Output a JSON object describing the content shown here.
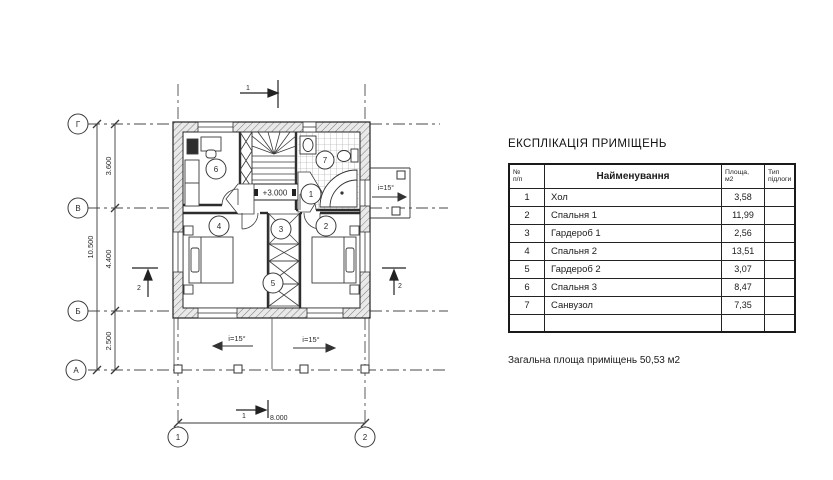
{
  "sheet": {
    "title": "ЕКСПЛІКАЦІЯ ПРИМІЩЕНЬ",
    "table": {
      "headers": {
        "num_l1": "№",
        "num_l2": "п/п",
        "name": "Найменування",
        "area_l1": "Площа,",
        "area_l2": "м2",
        "floor_l1": "Тип",
        "floor_l2": "підлоги"
      },
      "rows": [
        {
          "num": "1",
          "name": "Хол",
          "area": "3,58",
          "floor": ""
        },
        {
          "num": "2",
          "name": "Спальня 1",
          "area": "11,99",
          "floor": ""
        },
        {
          "num": "3",
          "name": "Гардероб 1",
          "area": "2,56",
          "floor": ""
        },
        {
          "num": "4",
          "name": "Спальня 2",
          "area": "13,51",
          "floor": ""
        },
        {
          "num": "5",
          "name": "Гардероб 2",
          "area": "3,07",
          "floor": ""
        },
        {
          "num": "6",
          "name": "Спальня 3",
          "area": "8,47",
          "floor": ""
        },
        {
          "num": "7",
          "name": "Санвузол",
          "area": "7,35",
          "floor": ""
        },
        {
          "num": "",
          "name": "",
          "area": "",
          "floor": ""
        }
      ]
    },
    "total": "Загальна площа приміщень  50,53 м2"
  },
  "plan": {
    "level_mark": "+3.000",
    "slope_label": "i=15°",
    "axes": {
      "g": "Г",
      "v": "В",
      "b": "Б",
      "a": "А",
      "one": "1",
      "two": "2"
    },
    "dims": {
      "total_v": "10.500",
      "seg1": "3.600",
      "seg2": "4.400",
      "seg3": "2.500",
      "width": "8.000"
    },
    "sections": {
      "s1": "1",
      "s2": "2"
    },
    "rooms": {
      "r1": "1",
      "r2": "2",
      "r3": "3",
      "r4": "4",
      "r5": "5",
      "r6": "6",
      "r7": "7"
    }
  },
  "colors": {
    "ink": "#2a2a2a",
    "paper": "#ffffff"
  }
}
